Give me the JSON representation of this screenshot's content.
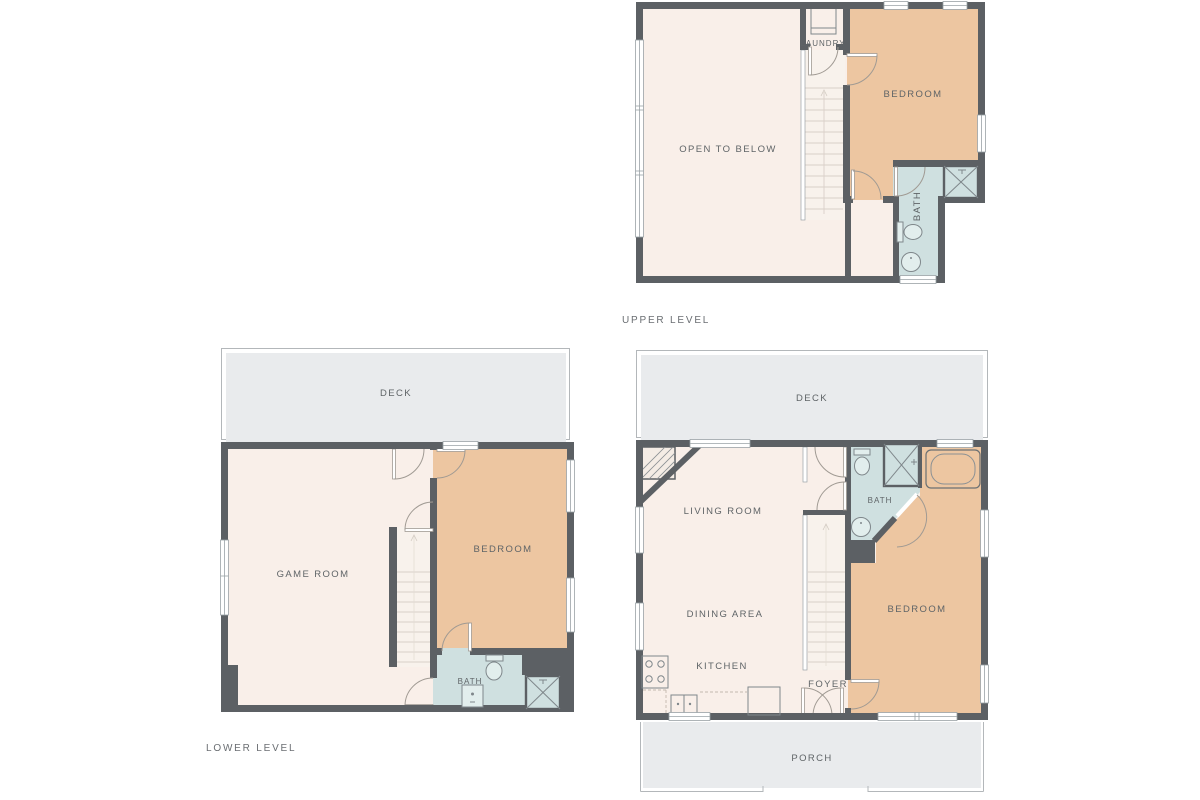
{
  "palette": {
    "wall": "#5c6064",
    "room_cream": "#f9efe9",
    "room_tan": "#edc6a1",
    "room_bath_blue": "#cfe0e0",
    "outdoor_gray": "#e9ebed",
    "label_text": "#5f6467"
  },
  "floors": {
    "upper": {
      "caption": "UPPER LEVEL",
      "labels": {
        "open_to_below": "OPEN TO BELOW",
        "laundry": "LAUNDRY",
        "bedroom": "BEDROOM",
        "bath": "BATH"
      }
    },
    "lower": {
      "caption": "LOWER LEVEL",
      "labels": {
        "deck": "DECK",
        "game_room": "GAME ROOM",
        "bedroom": "BEDROOM",
        "bath": "BATH"
      }
    },
    "main": {
      "labels": {
        "deck": "DECK",
        "living_room": "LIVING ROOM",
        "dining_area": "DINING AREA",
        "kitchen": "KITCHEN",
        "foyer": "FOYER",
        "bedroom": "BEDROOM",
        "bath": "BATH",
        "porch": "PORCH"
      }
    }
  }
}
